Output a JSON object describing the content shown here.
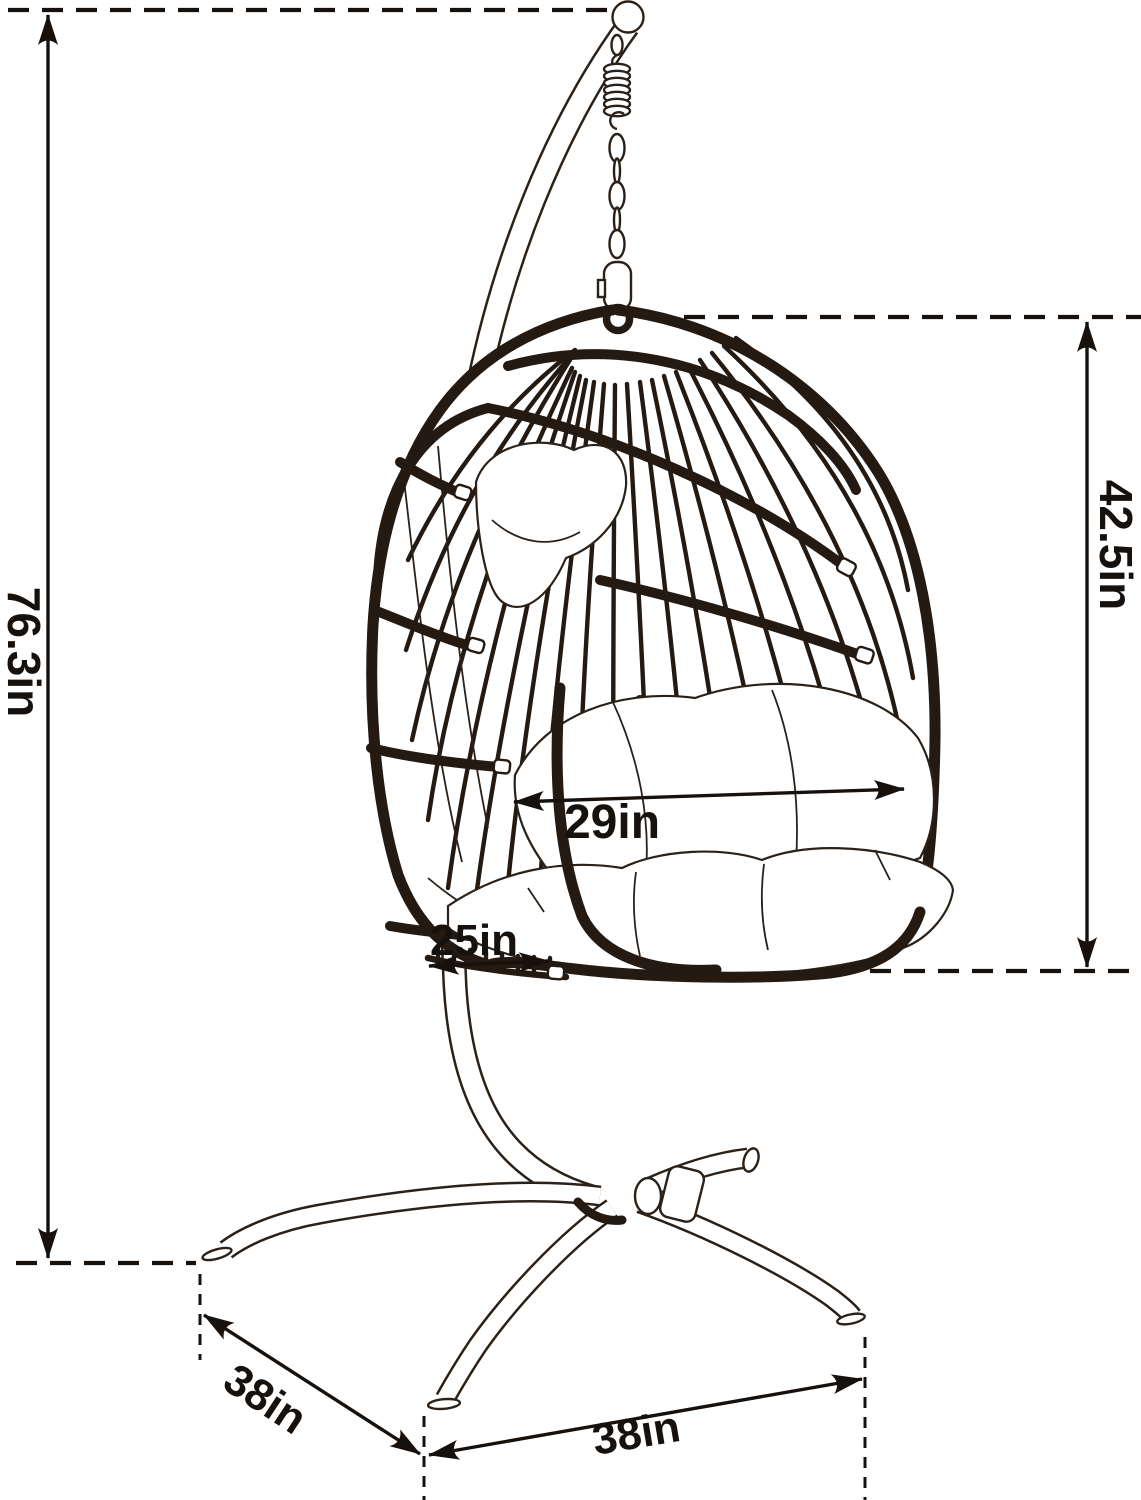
{
  "diagram": {
    "type": "product-dimension-diagram",
    "subject": "hanging egg swing chair with C-stand",
    "labels": {
      "overall_height": "76.3in",
      "chair_height": "42.5in",
      "chair_width": "29in",
      "seat_depth": "25in",
      "base_depth": "38in",
      "base_width": "38in"
    },
    "colors": {
      "background": "#ffffff",
      "ink": "#251a12",
      "dimension": "#17110d"
    }
  }
}
